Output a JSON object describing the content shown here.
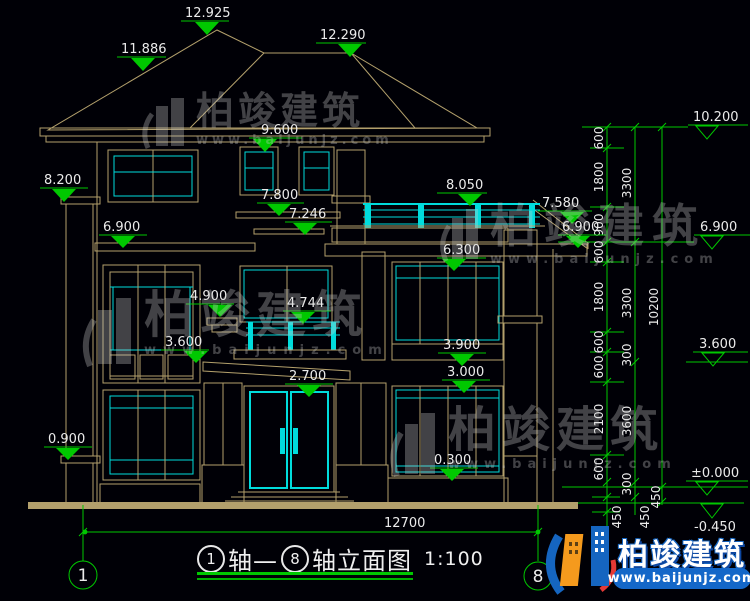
{
  "drawing": {
    "caption": {
      "axis_left": "1",
      "joiner": "轴—",
      "axis_right": "8",
      "suffix": "轴立面图",
      "scale": "1:100"
    },
    "axis_bubbles": {
      "left": "1",
      "right": "8"
    },
    "total_width_dim": "12700",
    "levels": {
      "ridge_main": "12.925",
      "slope_left": "11.886",
      "ridge_right": "12.290",
      "eave": "9.600",
      "pilaster_left": "8.200",
      "balcony3_rail": "8.050",
      "win3_sill": "7.800",
      "wing_roof": "7.580",
      "ledge3": "7.246",
      "floor3_left": "6.900",
      "wing_eave": "6.900",
      "slab_right": "6.300",
      "canopy_mid": "4.900",
      "balcony2_rail": "4.744",
      "win2r_sill": "3.900",
      "floor2_left": "3.600",
      "win1r_top": "3.000",
      "door_top": "2.700",
      "pillar_base": "0.900",
      "win1r_sill": "0.300"
    },
    "right_scale": {
      "top": "10.200",
      "mid": "6.900",
      "low": "3.600",
      "zero": "±0.000",
      "below": "-0.450"
    },
    "dim_col_inner": [
      "600",
      "1800",
      "900",
      "600",
      "1800",
      "600",
      "600",
      "2100",
      "600"
    ],
    "dim_col_mid": [
      "3300",
      "3300",
      "300",
      "3600",
      "300"
    ],
    "dim_col_outer": [
      "10200"
    ],
    "dim_bottom": [
      "450",
      "450",
      "450"
    ]
  },
  "watermark": {
    "brand": "柏竣建筑",
    "url": "www.baijunjz.com"
  },
  "logo": {
    "brand": "柏竣建筑",
    "url": "www.baijunjz.com"
  },
  "colors": {
    "background": "#000006",
    "cad_line": "#b3a06c",
    "window_frame": "#00dcdc",
    "dimension": "#00c800",
    "text": "#ebebeb",
    "logo_blue": "#1565c0",
    "logo_orange": "#f59a1d"
  }
}
